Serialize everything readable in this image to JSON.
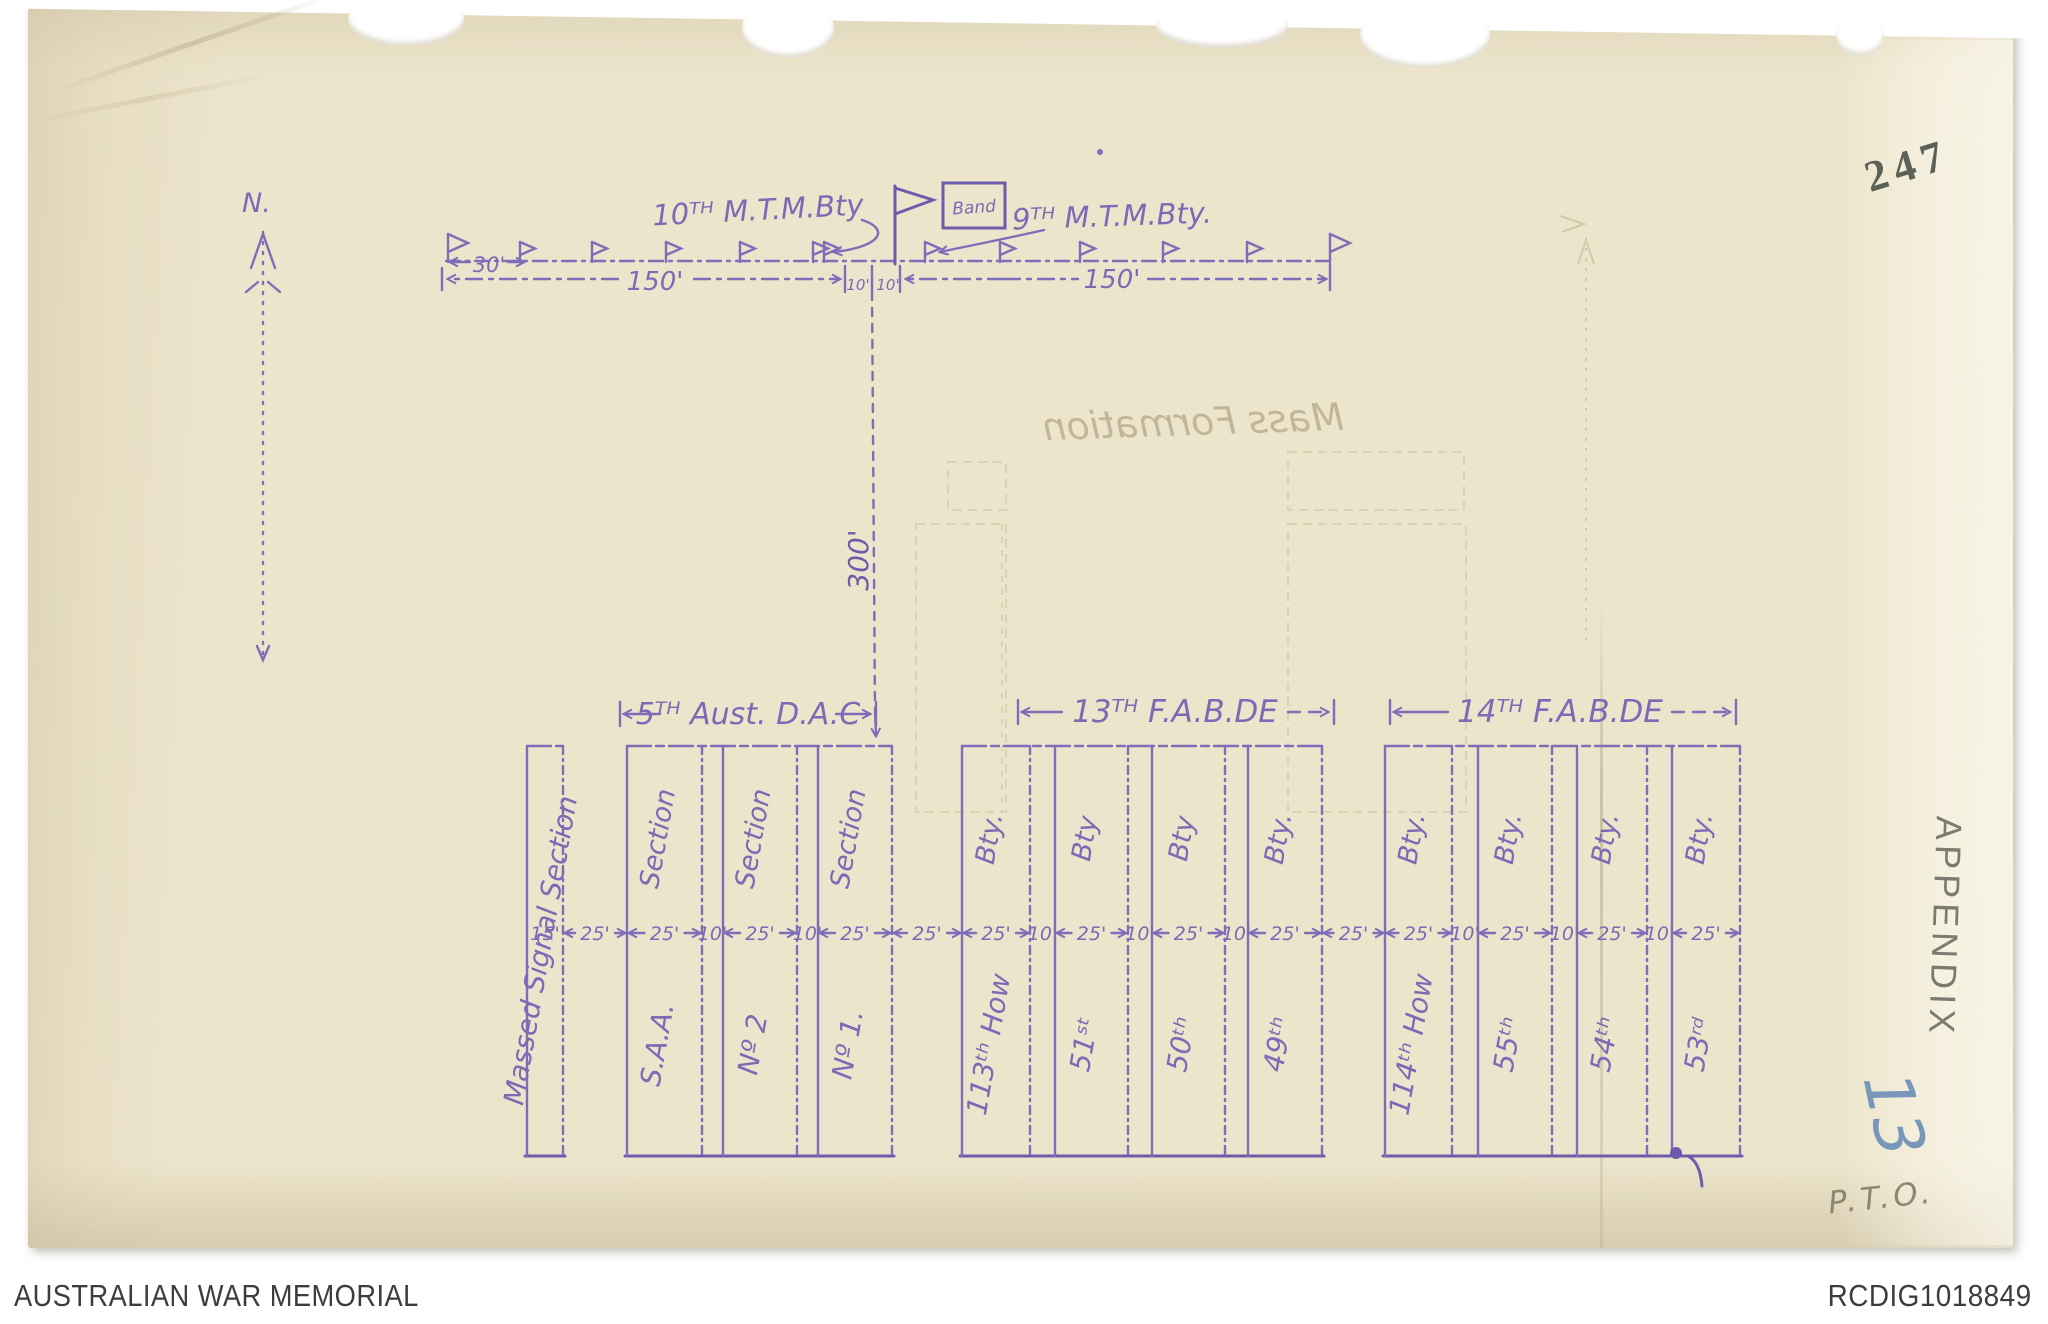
{
  "page": {
    "number_stamp": "247",
    "appendix_stamp": "APPENDIX",
    "appendix_number": "13",
    "pto_note": "P.T.O.",
    "footer": {
      "left_text": "AUSTRALIAN WAR MEMORIAL",
      "right_text": "RCDIG1018849"
    }
  },
  "diagram": {
    "ink_color": "#7e6db8",
    "north_label": "N.",
    "front_line": {
      "left_unit_label": "10ᵀᴴ M.T.M.Bty",
      "band_label": "Band",
      "right_unit_label": "9ᵀᴴ M.T.M.Bty.",
      "measurements": [
        "30'",
        "150'",
        "10'",
        "10'",
        "150'"
      ]
    },
    "depth_measurement": "300'",
    "groups": [
      {
        "label": "5ᵀᴴ Aust. D.A.C"
      },
      {
        "label": "13ᵀᴴ F.A.B.DE"
      },
      {
        "label": "14ᵀᴴ F.A.B.DE"
      }
    ],
    "columns": [
      {
        "full_label": "Massed Signal Section"
      },
      {
        "top_label": "Section",
        "bottom_label": "S.A.A."
      },
      {
        "top_label": "Section",
        "bottom_label": "Nº 2"
      },
      {
        "top_label": "Section",
        "bottom_label": "Nº 1."
      },
      {
        "top_label": "Bty.",
        "bottom_label": "113ᵗʰ How"
      },
      {
        "top_label": "Bty",
        "bottom_label": "51ˢᵗ"
      },
      {
        "top_label": "Bty",
        "bottom_label": "50ᵗʰ"
      },
      {
        "top_label": "Bty.",
        "bottom_label": "49ᵗʰ"
      },
      {
        "top_label": "Bty.",
        "bottom_label": "114ᵗʰ How"
      },
      {
        "top_label": "Bty.",
        "bottom_label": "55ᵗʰ"
      },
      {
        "top_label": "Bty.",
        "bottom_label": "54ᵗʰ"
      },
      {
        "top_label": "Bty.",
        "bottom_label": "53ʳᵈ"
      }
    ],
    "width_measurements": [
      "15'",
      "25'",
      "25'",
      "10'",
      "25'",
      "10'",
      "25'",
      "25'",
      "25'",
      "10'",
      "25'",
      "10'",
      "25'",
      "10'",
      "25'",
      "25'",
      "25'",
      "10'",
      "25'",
      "10'",
      "25'",
      "10'",
      "25'"
    ],
    "bleedthrough_title": "Mass Formation"
  }
}
